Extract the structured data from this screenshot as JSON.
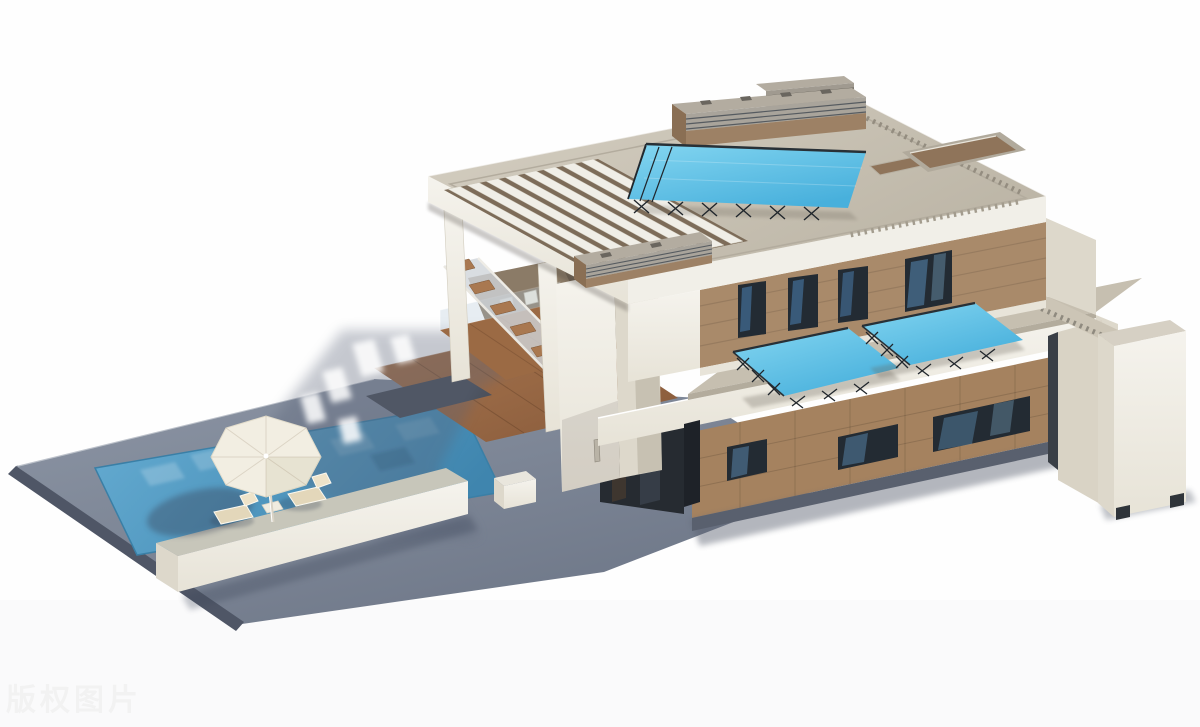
{
  "canvas": {
    "width": 1200,
    "height": 727
  },
  "watermark": {
    "text": "版权图片"
  },
  "scene": {
    "type": "3d-architectural-render",
    "subject": "modern two-storey flat-roof villa with tilted rooftop solar panels, roof vents, pergola slats, open mezzanine terrace with staircase, brown panel facades with strip windows, wooden deck, grey pool terrace with swimming pool, white parasol, sun loungers, low planter wall and detached white pillar",
    "elements": [
      "main-roof",
      "pergola-slats",
      "rooftop-solar-panel",
      "roof-vent",
      "roof-recess",
      "upper-floor-facade",
      "upper-windows",
      "lower-roof-terrace",
      "terrace-solar-panel-left",
      "terrace-solar-panel-right",
      "dentil-parapet",
      "ground-floor-facade",
      "strip-windows",
      "entry-recess",
      "staircase",
      "mezzanine-terrace",
      "wooden-deck",
      "pool-terrace",
      "swimming-pool",
      "parasol",
      "sun-loungers",
      "side-table",
      "planter-wall",
      "right-pillar",
      "building-shadow",
      "watermark"
    ]
  },
  "palette": {
    "background": "#fefefe",
    "wall-white": "#f1efe8",
    "wall-shadow": "#ddd8cb",
    "roof-top": "#c9c2b3",
    "facade-brown": "#a5825f",
    "wood-deck": "#9a6843",
    "paving-gray": "#7d8697",
    "paving-edge": "#4f5666",
    "pool-blue": "#4f9ecb",
    "solar-blue": "#5fc0e6",
    "truss-black": "#20262c",
    "window-dark": "#232b33",
    "plinth-gray": "#59606e",
    "umbrella-white": "#f2eee2",
    "watermark-gray": "#f2f2f2"
  }
}
